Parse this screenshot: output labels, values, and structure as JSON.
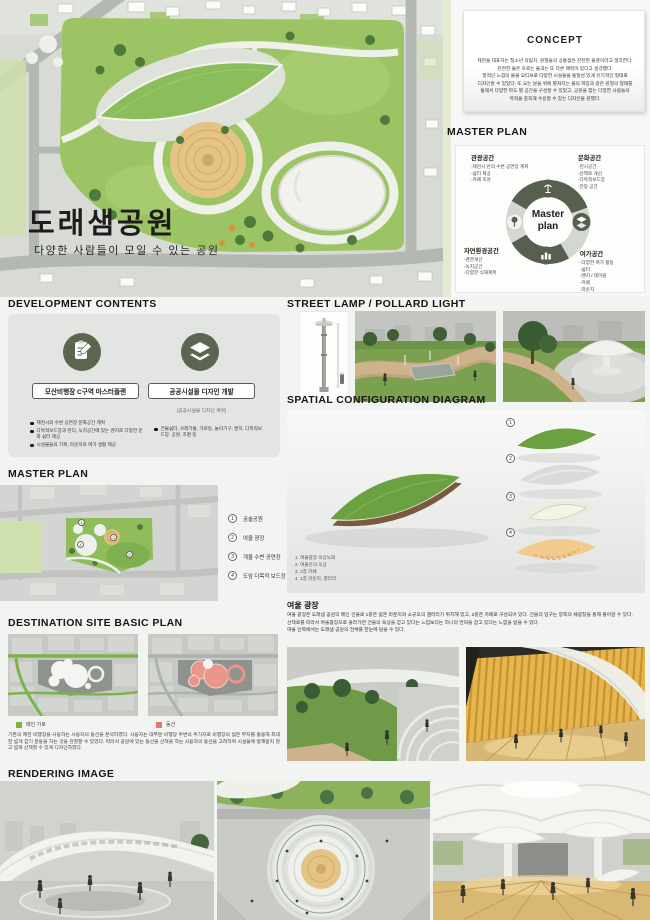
{
  "poster": {
    "title": "도래샘공원",
    "subtitle": "다양한 사람들이 모일 수 있는  공원"
  },
  "concept": {
    "heading": "CONCEPT",
    "lines": [
      "제천을 대표하는 청소년 의림지, 원형들의 공통점은 잔잔한 물결이라고 생각한다.",
      "잔잔한 물은 흐르는 물과는 또 다른 매력이 있다고 생각했다.",
      "정적인 느낌의 물을 모티브로 다양한 시설물을 통일성 있게 유기적인 형태로",
      "디자인할 수 있었다. 또 오는 날들 위에 펼쳐지는 물의 파장과 같은 원형의 형태를",
      "통해서 다양한 파도 별 공간을 구성할 수 있었고, 공원을 찾는 다양한 사람들의",
      "목적을 충족해 수용할 수 있는 디자인을 원했다."
    ]
  },
  "mp_diagram": {
    "heading": "MASTER PLAN",
    "center1": "Master",
    "center2": "plan",
    "quadrants": [
      {
        "title": "관광공간",
        "items": [
          "-제천시 안의 수변 공연장 계획",
          "-쉼터 제공",
          "-카페 조성"
        ]
      },
      {
        "title": "문화공간",
        "items": [
          "-전시공간",
          "-산책로 개선",
          "-다목적보드장",
          "-전망 공간"
        ]
      },
      {
        "title": "자연환경공간",
        "items": [
          "-경관개선",
          "-녹지공간",
          "-다양한 식재계획"
        ]
      },
      {
        "title": "여가공간",
        "items": [
          "-다양한 여가 활동",
          "-쉼터",
          "-벤치 / 테이블",
          "-카페",
          "-라운지"
        ]
      }
    ]
  },
  "development": {
    "heading": "DEVELOPMENT CONTENTS",
    "left_label": "모산비행장 C구역 마스터플랜",
    "right_label": "공공시설물 디자인 개발",
    "right_sublabel": "[공공시설물 디자인 계획]",
    "left_bullets": [
      "제천시의 수변 공연장 문화공간 계획",
      "다목적보드장과 잔디, 녹지공간에 있는 벤치로 다양한 문화 쉼터 제공",
      "시설물들의 기획, 라운지로 여가 생활 제공"
    ],
    "right_bullets": [
      "건물쉼터, 쓰레기통, 가로등, 놀이기구, 벤치, 다목적보드장, 공원, 조명 등"
    ]
  },
  "street_lamp": {
    "heading": "STREET LAMP / POLLARD LIGHT"
  },
  "spatial": {
    "heading": "SPATIAL CONFIGURATION DIAGRAM",
    "captions": [
      "1. 여울광장 옥상녹화",
      "2. 여울안의 옥상",
      "3. 2층 카페",
      "4. 1층 라운지, 갤러리"
    ]
  },
  "mp_map": {
    "heading": "MASTER PLAN",
    "legend": [
      {
        "num": "1",
        "label": "곰솔공원"
      },
      {
        "num": "2",
        "label": "여울 광장"
      },
      {
        "num": "3",
        "label": "개울 수변 공연장"
      },
      {
        "num": "4",
        "label": "도암 다목적 보드장"
      }
    ]
  },
  "yeoul": {
    "heading": "여울 광장",
    "lines": [
      "여울 광장은 도래샘 공원의 메인 건물로 1층은 넓은 라운지와 소규모의 갤러리가 위치해 있고, 2층은 카페로 구성되어 있다. 건물의 입구는 양쪽의 채광창을 통해 들어갈 수 있다.",
      "산책로를 따라서 여울광장으로 올라가면 건물의 옥상을 걷고 있다는 느낌보다는 하나의 언덕을 걷고 있다는 느낌을 받을 수 있다.",
      "여울 안쪽에서는 도래샘 공원의 전체를 한눈에 담을 수 있다."
    ]
  },
  "destination": {
    "heading": "DESTINATION SITE BASIC PLAN",
    "legend_green": "메인 가로",
    "legend_red": "동선",
    "paragraph": "기존의 제천 비행장을 사용하는 사용자의 동선을 분석하였다. 사용자는 대부분 비행장 주변의 주거지로 비행장의 넓은 부지를 활용해 최대한 넓게 걷기 운동을 하는 것을 관찰할 수 있었다. 따라서 공원에 있는 동선을 산책을 하는 사용자의 동선을 고려하여 시설물에 방해받지 않고 넓게 산책할 수 있게 디자인하였다."
  },
  "rendering": {
    "heading": "RENDERING IMAGE"
  },
  "colors": {
    "park_green": "#9cc464",
    "dark_olive": "#57604e",
    "sand": "#e4c385",
    "leaf_orange": "#f3ca8d",
    "legend_green": "#7cb449",
    "legend_red": "#e0796b",
    "panel_gray": "#e3e5e2"
  }
}
